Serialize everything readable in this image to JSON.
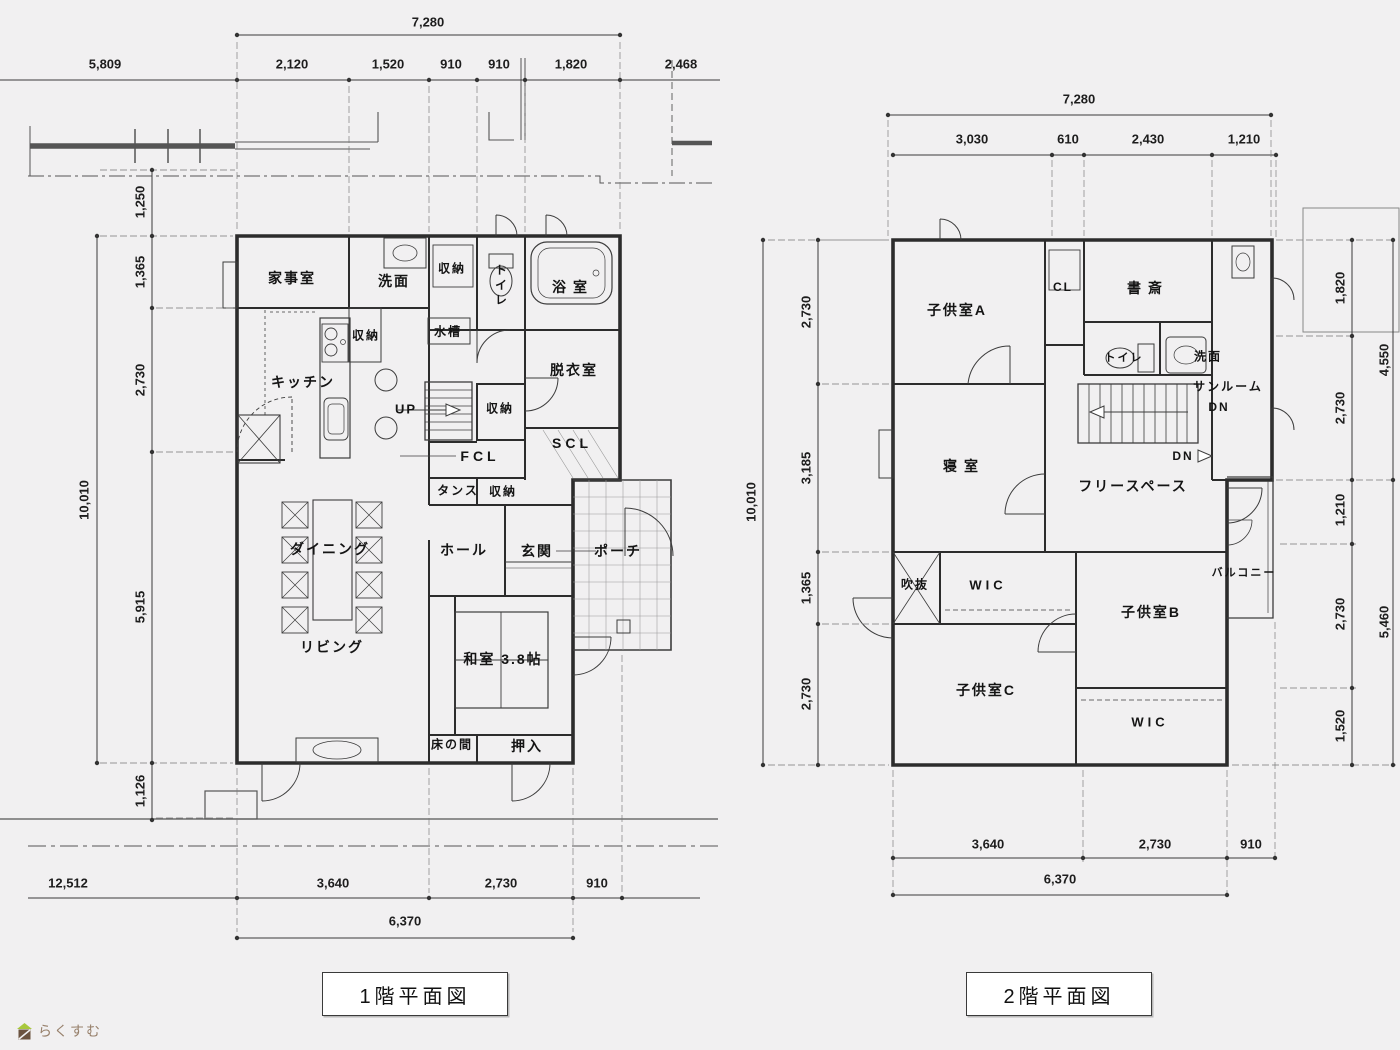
{
  "page": {
    "background": "#f1f0f1",
    "line_color": "#2c2c2c"
  },
  "logo": {
    "text": "らくすむ"
  },
  "floor1": {
    "title": "1階平面図",
    "rooms": {
      "kaji": "家事室",
      "senmen": "洗面",
      "shuno_top": "収納",
      "toire": "トイレ",
      "yokushitsu": "浴室",
      "kitchen": "キッチン",
      "shuno_kitchen": "収納",
      "suiso": "水槽",
      "datsui": "脱衣室",
      "up": "UP",
      "shuno_stair": "収納",
      "fcl": "FCL",
      "scl": "SCL",
      "tansu": "タンス",
      "shuno_fcl": "収納",
      "dining": "ダイニング",
      "hall": "ホール",
      "genkan": "玄関",
      "porch": "ポーチ",
      "living": "リビング",
      "washitsu": "和室 3.8帖",
      "tokonoma": "床の間",
      "oshiire": "押入"
    },
    "dims": {
      "top_total": "7,280",
      "top_row": [
        "5,809",
        "2,120",
        "1,520",
        "910",
        "910",
        "1,820",
        "2,468"
      ],
      "left_total": "10,010",
      "left_col": [
        "1,250",
        "1,365",
        "2,730",
        "5,915",
        "1,126"
      ],
      "bottom_row": [
        "12,512",
        "3,640",
        "2,730",
        "910"
      ],
      "bottom_total": "6,370"
    }
  },
  "floor2": {
    "title": "2階平面図",
    "rooms": {
      "kodomoA": "子供室A",
      "cl": "CL",
      "shosai": "書斎",
      "toire": "トイレ",
      "senmen": "洗面",
      "sunroom": "サンルーム",
      "dn1": "DN",
      "dn2": "DN",
      "shinshitsu": "寝室",
      "free": "フリースペース",
      "fukinuke": "吹抜",
      "wic1": "WIC",
      "kodomoB": "子供室B",
      "balcony": "バルコニー",
      "kodomoC": "子供室C",
      "wic2": "WIC"
    },
    "dims": {
      "top_total": "7,280",
      "top_row": [
        "3,030",
        "610",
        "2,430",
        "1,210"
      ],
      "left_total": "10,010",
      "left_col": [
        "2,730",
        "3,185",
        "1,365",
        "2,730"
      ],
      "right_col": [
        "1,820",
        "2,730",
        "1,210",
        "2,730",
        "1,520"
      ],
      "right_outer": [
        "4,550",
        "5,460"
      ],
      "bottom_row": [
        "3,640",
        "2,730",
        "910"
      ],
      "bottom_total": "6,370"
    }
  }
}
